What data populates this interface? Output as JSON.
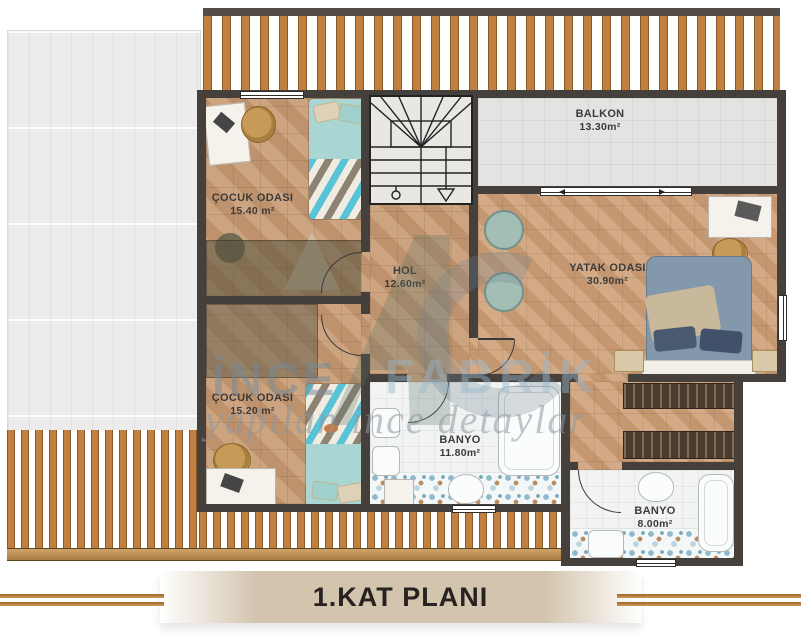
{
  "plan": {
    "title": "1.KAT PLANI",
    "watermark": {
      "brand_left": "İNCE",
      "brand_right": "FABRİK",
      "slogan": "yapılan ince detaylar"
    },
    "rooms": {
      "cocuk_ust": {
        "name": "ÇOCUK ODASI",
        "area": "15.40 m²"
      },
      "hol": {
        "name": "HOL",
        "area": "12.60m²"
      },
      "balkon": {
        "name": "BALKON",
        "area": "13.30m²"
      },
      "yatak": {
        "name": "YATAK ODASI",
        "area": "30.90m²"
      },
      "cocuk_alt": {
        "name": "ÇOCUK ODASI",
        "area": "15.20 m²"
      },
      "banyo_buyuk": {
        "name": "BANYO",
        "area": "11.80m²"
      },
      "banyo_kucuk": {
        "name": "BANYO",
        "area": "8.00m²"
      }
    },
    "colors": {
      "wall": "#45403c",
      "parquet": "#c69a73",
      "deck_slat": "#c1803f",
      "balcony_tile": "#e3e3e1",
      "title_band": "#d3c4ae",
      "accent_line": "#b5773a"
    }
  }
}
